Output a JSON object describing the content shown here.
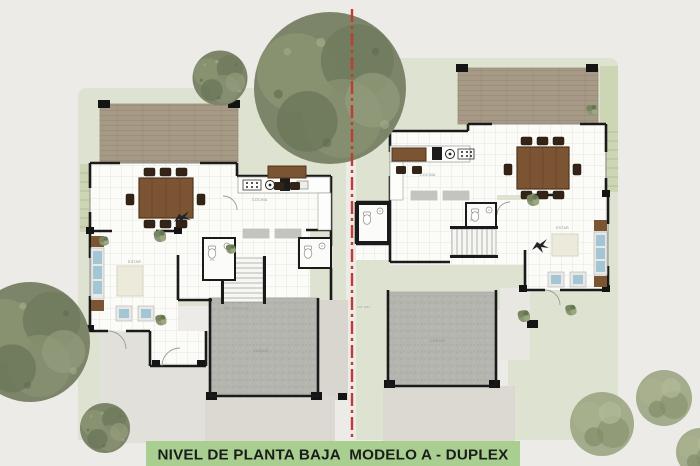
{
  "banner": {
    "title": "NIVEL DE PLANTA BAJA  MODELO A - DUPLEX"
  },
  "plan": {
    "property_line": {
      "color": "#c23b30",
      "style": "dash-dot"
    },
    "units": [
      {
        "id": "left",
        "labels": {
          "kitchen": "COCINA",
          "garage": "GARAJE",
          "living": "ESTAR",
          "bath": "WC",
          "stair_note": "AMP. HASTA 2.20"
        }
      },
      {
        "id": "right",
        "labels": {
          "kitchen": "COCINA",
          "garage": "GARAJE",
          "living": "ESTAR",
          "bath": "WC",
          "stair_note": "AMP. HASTA 2.20",
          "lot_note": "LOT. MFL"
        }
      }
    ]
  },
  "colors": {
    "paper": "#ecebe7",
    "lawn": "#dde3d0",
    "deck_wood": "#a69a87",
    "wall": "#1a1a1a",
    "garage_slab": "#b5b5b0",
    "driveway": "#dbd9d2",
    "table_wood": "#7b5433",
    "chair_wood": "#342317",
    "sofa_cushion": "#a3c6d6",
    "tree_green": "#7c8569",
    "bush_green": "#9ba583",
    "banner_bg": "#a8cf90",
    "banner_text": "#1c1c1c"
  }
}
